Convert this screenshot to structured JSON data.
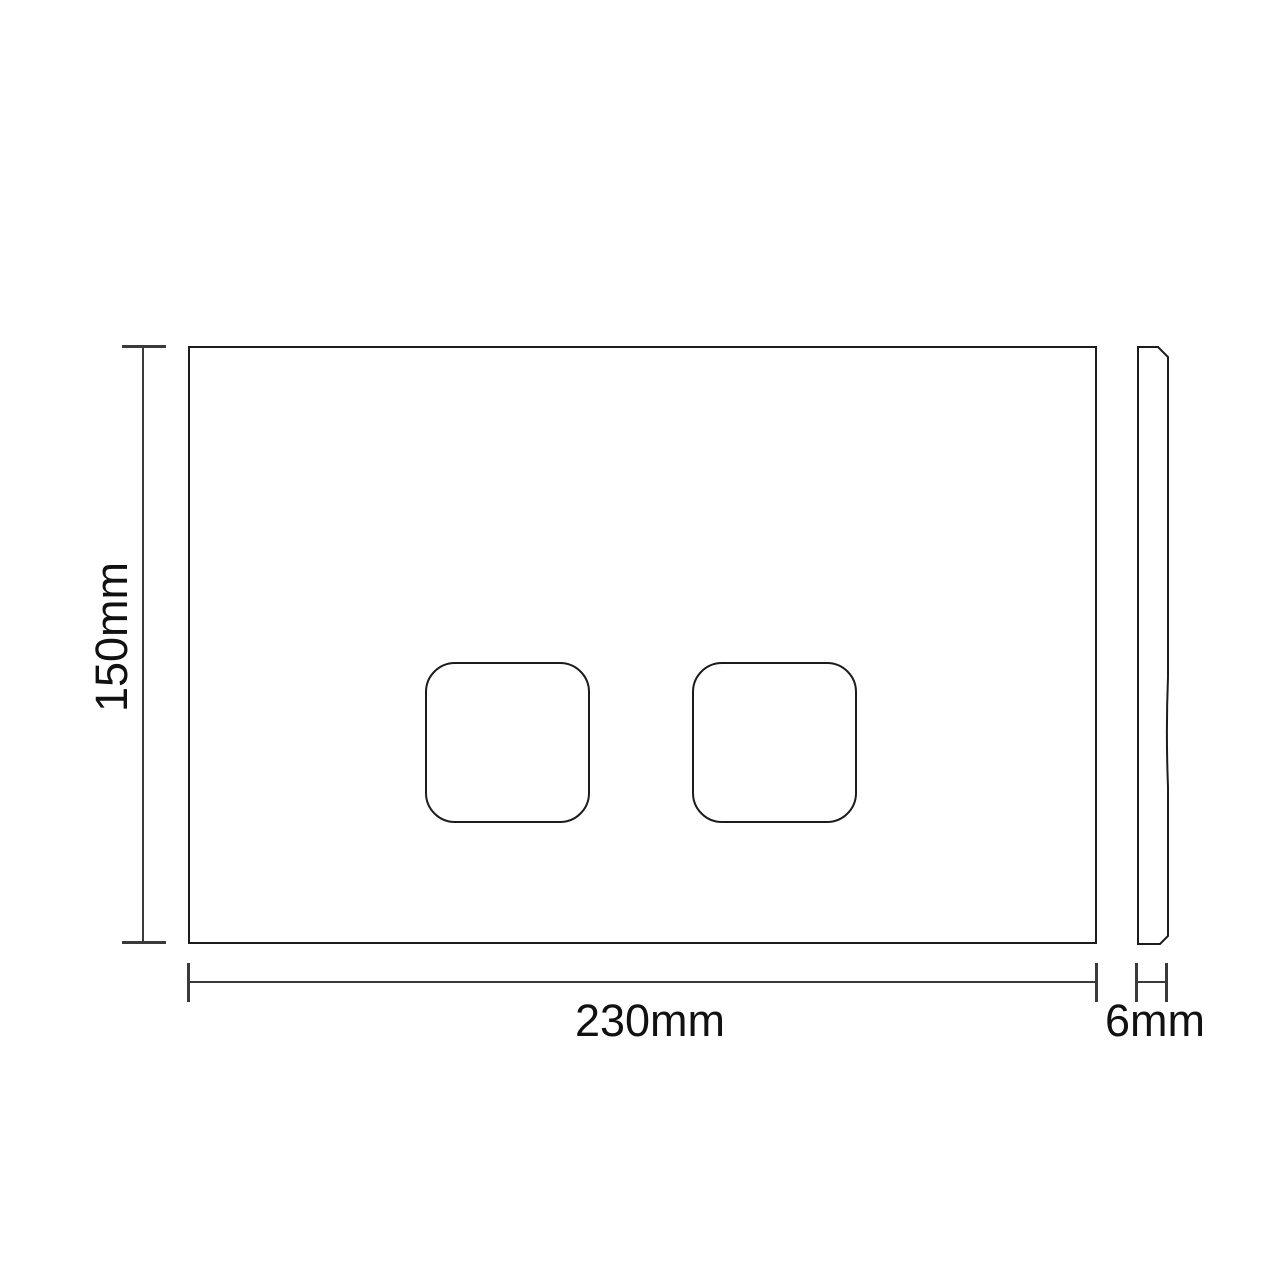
{
  "dimensions": {
    "height": "150mm",
    "width": "230mm",
    "thickness": "6mm"
  },
  "colors": {
    "outline": "#1c1c1c",
    "dimension_line": "#3a3a3a",
    "text": "#111111",
    "background": "#ffffff"
  }
}
